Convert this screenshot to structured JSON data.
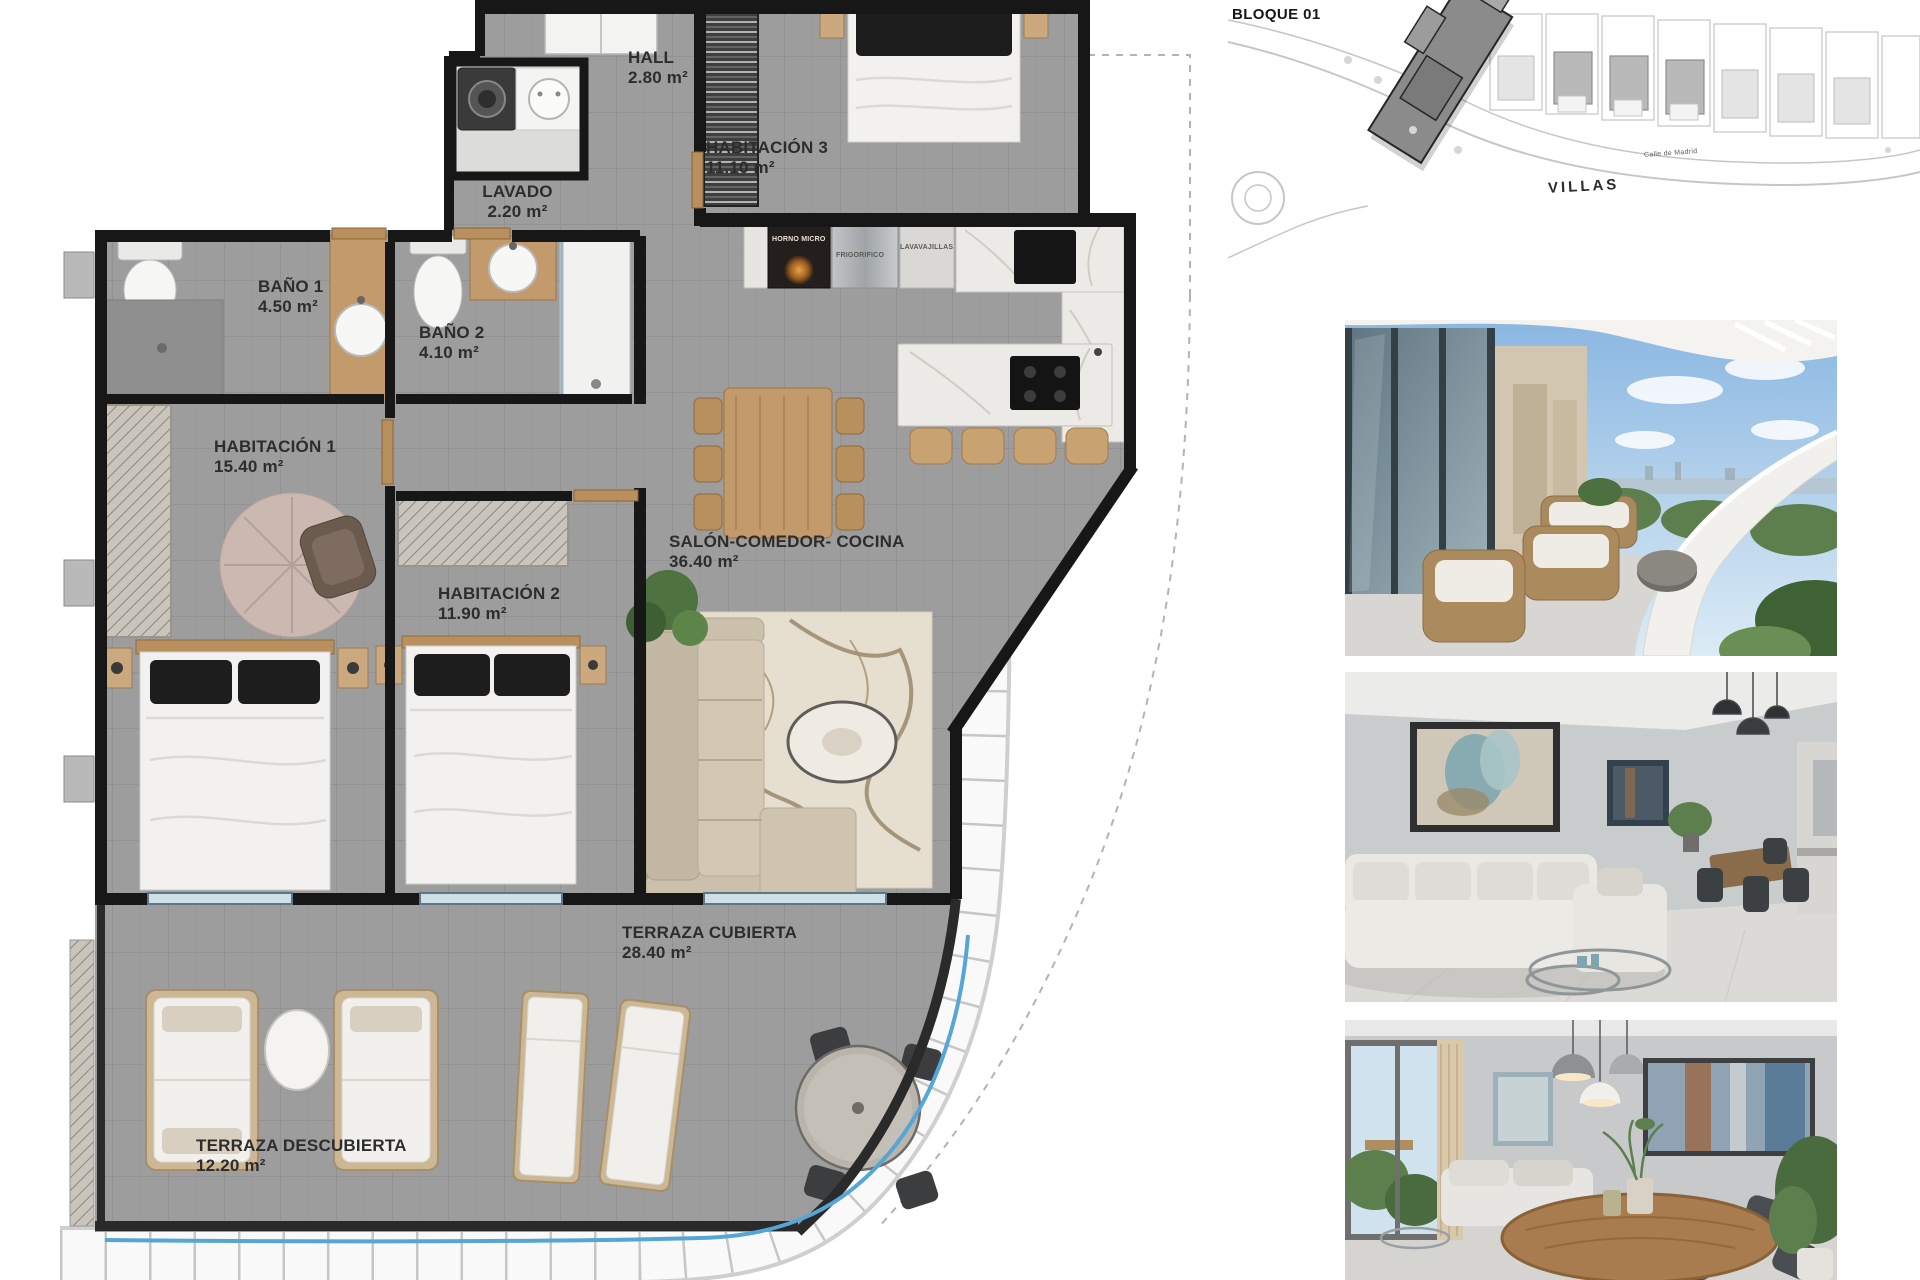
{
  "plan": {
    "rooms": [
      {
        "name": "HALL",
        "area": "2.80 m²"
      },
      {
        "name": "LAVADO",
        "area": "2.20 m²"
      },
      {
        "name": "HABITACIÓN 3",
        "area": "11.10 m²"
      },
      {
        "name": "BAÑO 1",
        "area": "4.50 m²"
      },
      {
        "name": "BAÑO 2",
        "area": "4.10 m²"
      },
      {
        "name": "HABITACIÓN 1",
        "area": "15.40 m²"
      },
      {
        "name": "HABITACIÓN 2",
        "area": "11.90 m²"
      },
      {
        "name": "SALÓN-COMEDOR- COCINA",
        "area": "36.40 m²"
      },
      {
        "name": "TERRAZA CUBIERTA",
        "area": "28.40 m²"
      },
      {
        "name": "TERRAZA DESCUBIERTA",
        "area": "12.20 m²"
      }
    ],
    "appliance_labels": [
      "HORNO MICRO",
      "FRIGORIFICO",
      "LAVAVAJILLAS"
    ]
  },
  "site_map": {
    "block_label": "BLOQUE 01",
    "villas_label": "VILLAS",
    "street_label": "Calle de Madrid"
  },
  "colors": {
    "floor_gray": "#9d9d9d",
    "wall_black": "#171717",
    "wood": "#c29a6b",
    "marble": "#eceae6",
    "water_blue": "#55a6d6",
    "rug_cream": "#e6dfd0"
  }
}
